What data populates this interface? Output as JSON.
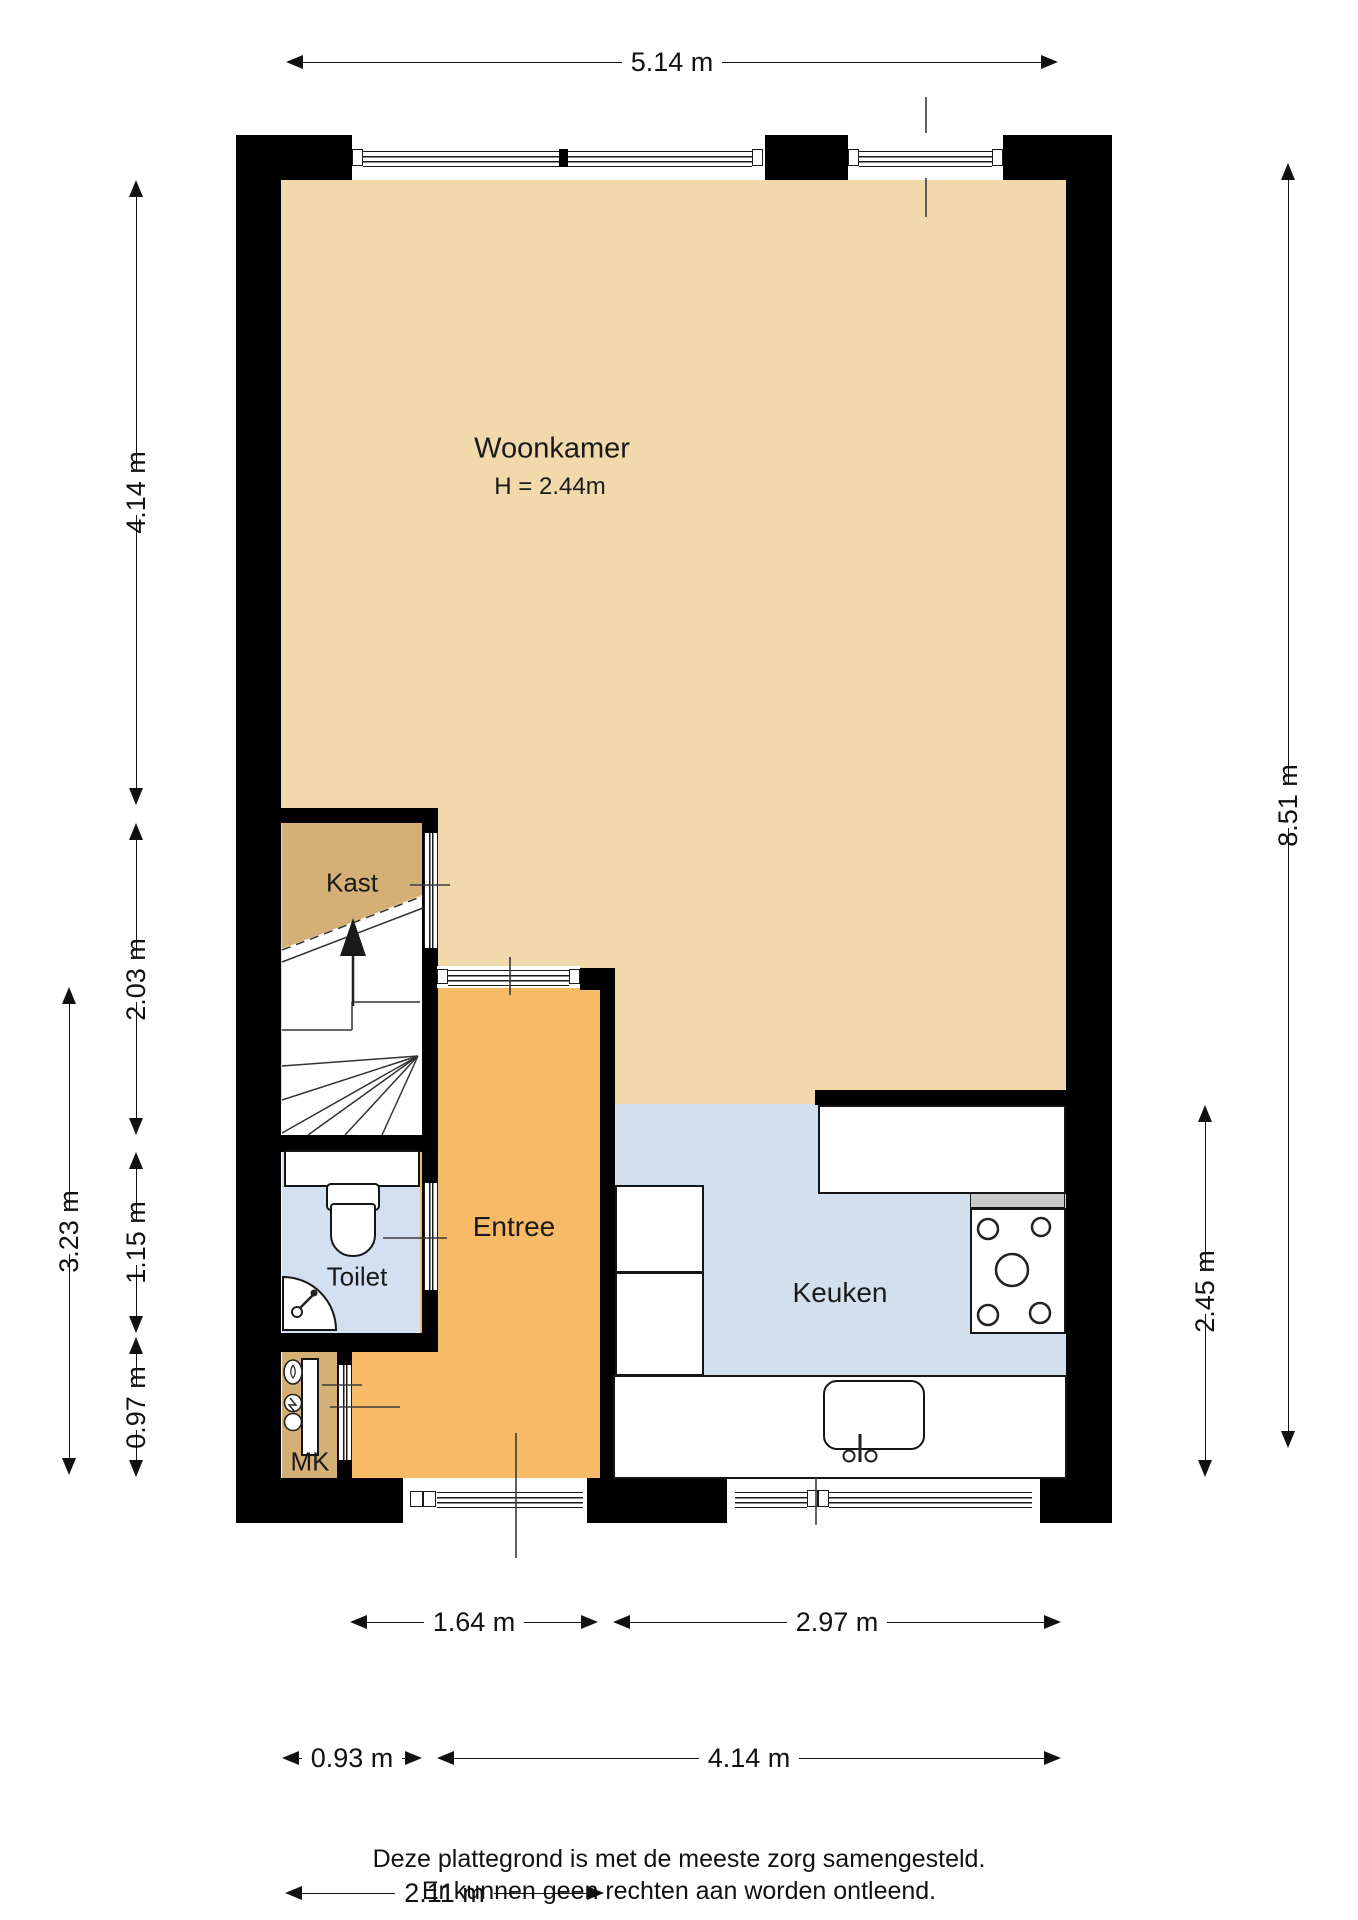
{
  "plan": {
    "rooms": {
      "woonkamer": {
        "label": "Woonkamer",
        "height_label": "H = 2.44m"
      },
      "kast": {
        "label": "Kast"
      },
      "entree": {
        "label": "Entree"
      },
      "toilet": {
        "label": "Toilet"
      },
      "keuken": {
        "label": "Keuken"
      },
      "mk": {
        "label": "MK"
      }
    },
    "dims": {
      "total_width": "5.14 m",
      "woonkamer_depth": "4.14 m",
      "stairs_depth": "2.03 m",
      "toilet_depth": "1.15 m",
      "mk_depth": "0.97 m",
      "hall_depth_total": "3.23 m",
      "total_depth": "8.51 m",
      "keuken_depth": "2.45 m",
      "entree_width": "1.64 m",
      "keuken_width": "2.97 m",
      "toilet_width": "0.93 m",
      "interior_width": "4.14 m",
      "hall_width": "2.11 m"
    },
    "footer": {
      "line1": "Deze plattegrond is met de meeste zorg samengesteld.",
      "line2": "Er kunnen geen rechten aan worden ontleend."
    },
    "colors": {
      "woonkamer_floor": "#f2d9ab",
      "entree_floor": "#f7ba67",
      "keuken_floor": "#d2e0ee",
      "toilet_floor": "#d2e0f2",
      "kast_mk_floor": "#d4b077",
      "wall": "#000000",
      "counter_edge": "#c9c9c9"
    },
    "icons": {
      "stairs_arrow": "up-arrow"
    }
  }
}
